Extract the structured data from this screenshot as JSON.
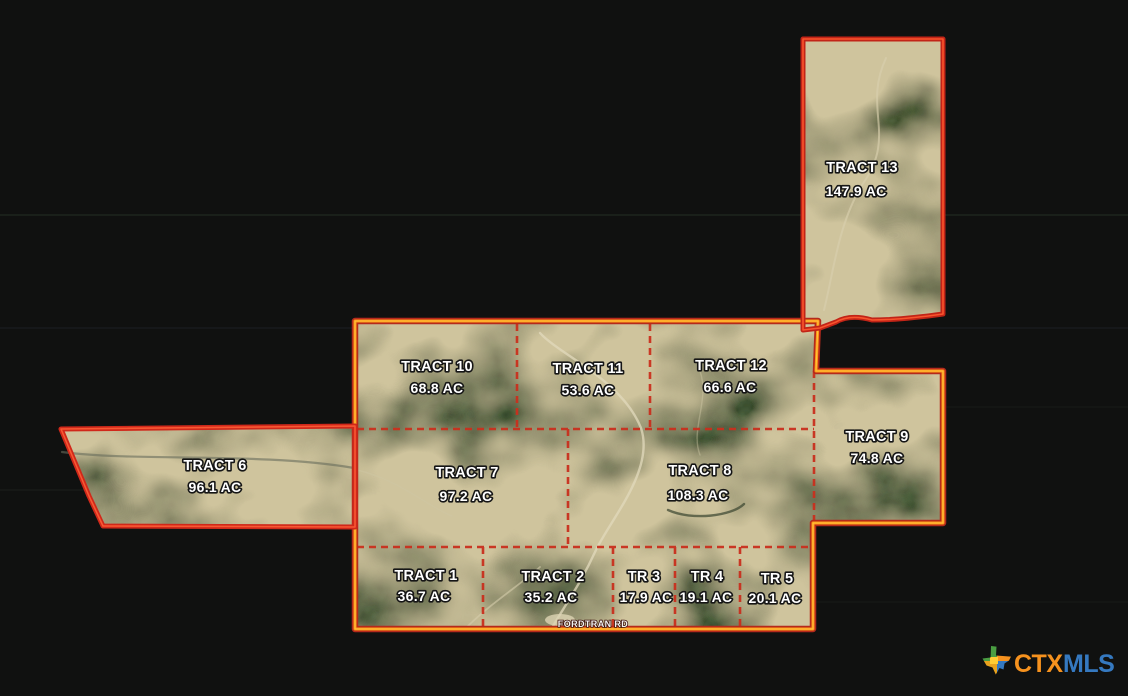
{
  "image": {
    "road_label": "FORDTRAN RD",
    "tracts": [
      {
        "id": "tract-13",
        "name": "TRACT 13",
        "acreage": "147.9 AC"
      },
      {
        "id": "tract-10",
        "name": "TRACT 10",
        "acreage": "68.8 AC"
      },
      {
        "id": "tract-11",
        "name": "TRACT 11",
        "acreage": "53.6 AC"
      },
      {
        "id": "tract-12",
        "name": "TRACT 12",
        "acreage": "66.6 AC"
      },
      {
        "id": "tract-9",
        "name": "TRACT 9",
        "acreage": "74.8 AC"
      },
      {
        "id": "tract-6",
        "name": "TRACT 6",
        "acreage": "96.1 AC"
      },
      {
        "id": "tract-7",
        "name": "TRACT 7",
        "acreage": "97.2 AC"
      },
      {
        "id": "tract-8",
        "name": "TRACT 8",
        "acreage": "108.3 AC"
      },
      {
        "id": "tract-1",
        "name": "TRACT 1",
        "acreage": "36.7 AC"
      },
      {
        "id": "tract-2",
        "name": "TRACT 2",
        "acreage": "35.2 AC"
      },
      {
        "id": "tract-3",
        "name": "TR 3",
        "acreage": "17.9 AC"
      },
      {
        "id": "tract-4",
        "name": "TR 4",
        "acreage": "19.1 AC"
      },
      {
        "id": "tract-5",
        "name": "TR 5",
        "acreage": "20.1 AC"
      }
    ],
    "colors": {
      "background": "#101110",
      "outer_boundary_red": "#c32718",
      "outer_boundary_orange": "#ff9615",
      "outer_boundary_yellow": "#ffd34d",
      "interior_division_dashed_red": "#c9301e",
      "label_text": "#ffffff"
    }
  },
  "branding": {
    "mls_name_part1": "CTX",
    "mls_name_part2": "MLS",
    "icon": "texas-state-icon",
    "colors": {
      "ctx": "#f6921e",
      "mls": "#3579c0"
    }
  }
}
